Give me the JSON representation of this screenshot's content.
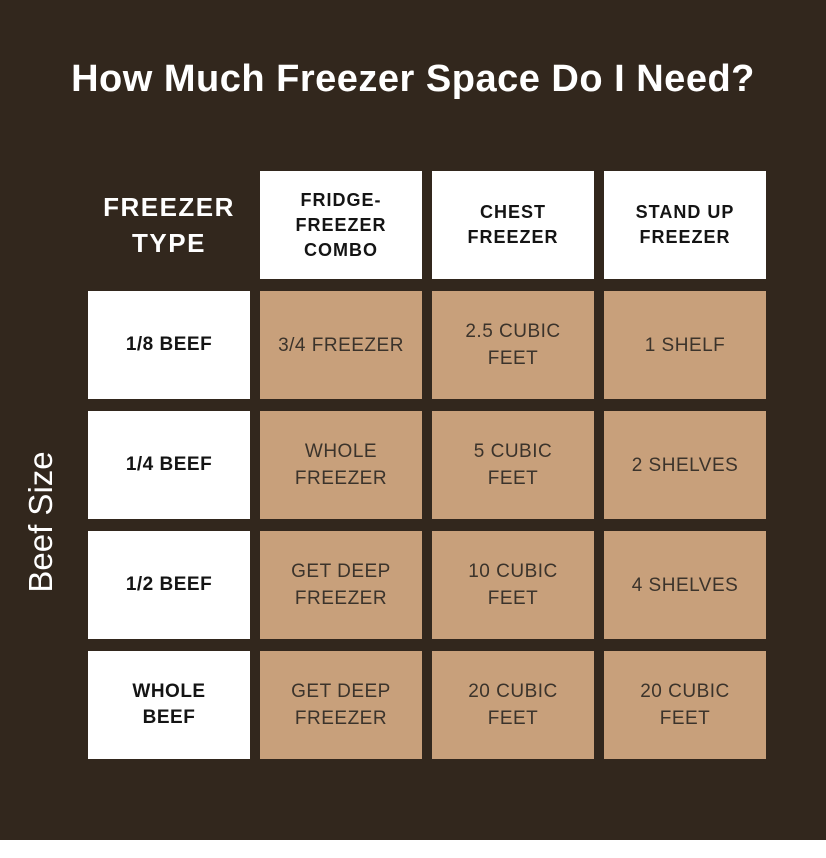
{
  "title": "How Much Freezer Space Do I Need?",
  "y_axis_label": "Beef Size",
  "colors": {
    "background": "#32271d",
    "data_cell": "#c8a07b",
    "label_cell": "#ffffff",
    "title_text": "#ffffff",
    "data_text": "#3b332b",
    "label_text": "#141414",
    "bottom_strip": "#ffffff"
  },
  "table": {
    "corner_label": "FREEZER\nTYPE",
    "column_headers": [
      "FRIDGE-\nFREEZER\nCOMBO",
      "CHEST\nFREEZER",
      "STAND UP\nFREEZER"
    ],
    "rows": [
      {
        "label": "1/8 BEEF",
        "cells": [
          "3/4 FREEZER",
          "2.5 CUBIC\nFEET",
          "1 SHELF"
        ]
      },
      {
        "label": "1/4 BEEF",
        "cells": [
          "WHOLE\nFREEZER",
          "5 CUBIC\nFEET",
          "2 SHELVES"
        ]
      },
      {
        "label": "1/2 BEEF",
        "cells": [
          "GET DEEP\nFREEZER",
          "10 CUBIC\nFEET",
          "4 SHELVES"
        ]
      },
      {
        "label": "WHOLE\nBEEF",
        "cells": [
          "GET DEEP\nFREEZER",
          "20 CUBIC\nFEET",
          "20 CUBIC\nFEET"
        ]
      }
    ]
  },
  "chart_data": {
    "type": "table",
    "title": "How Much Freezer Space Do I Need?",
    "row_axis_label": "Beef Size",
    "column_axis_label": "FREEZER TYPE",
    "columns": [
      "FRIDGE-FREEZER COMBO",
      "CHEST FREEZER",
      "STAND UP FREEZER"
    ],
    "row_categories": [
      "1/8 BEEF",
      "1/4 BEEF",
      "1/2 BEEF",
      "WHOLE BEEF"
    ],
    "values": [
      [
        "3/4 FREEZER",
        "2.5 CUBIC FEET",
        "1 SHELF"
      ],
      [
        "WHOLE FREEZER",
        "5 CUBIC FEET",
        "2 SHELVES"
      ],
      [
        "GET DEEP FREEZER",
        "10 CUBIC FEET",
        "4 SHELVES"
      ],
      [
        "GET DEEP FREEZER",
        "20 CUBIC FEET",
        "20 CUBIC FEET"
      ]
    ],
    "cubic_feet_numeric": [
      2.5,
      5,
      10,
      20
    ]
  }
}
